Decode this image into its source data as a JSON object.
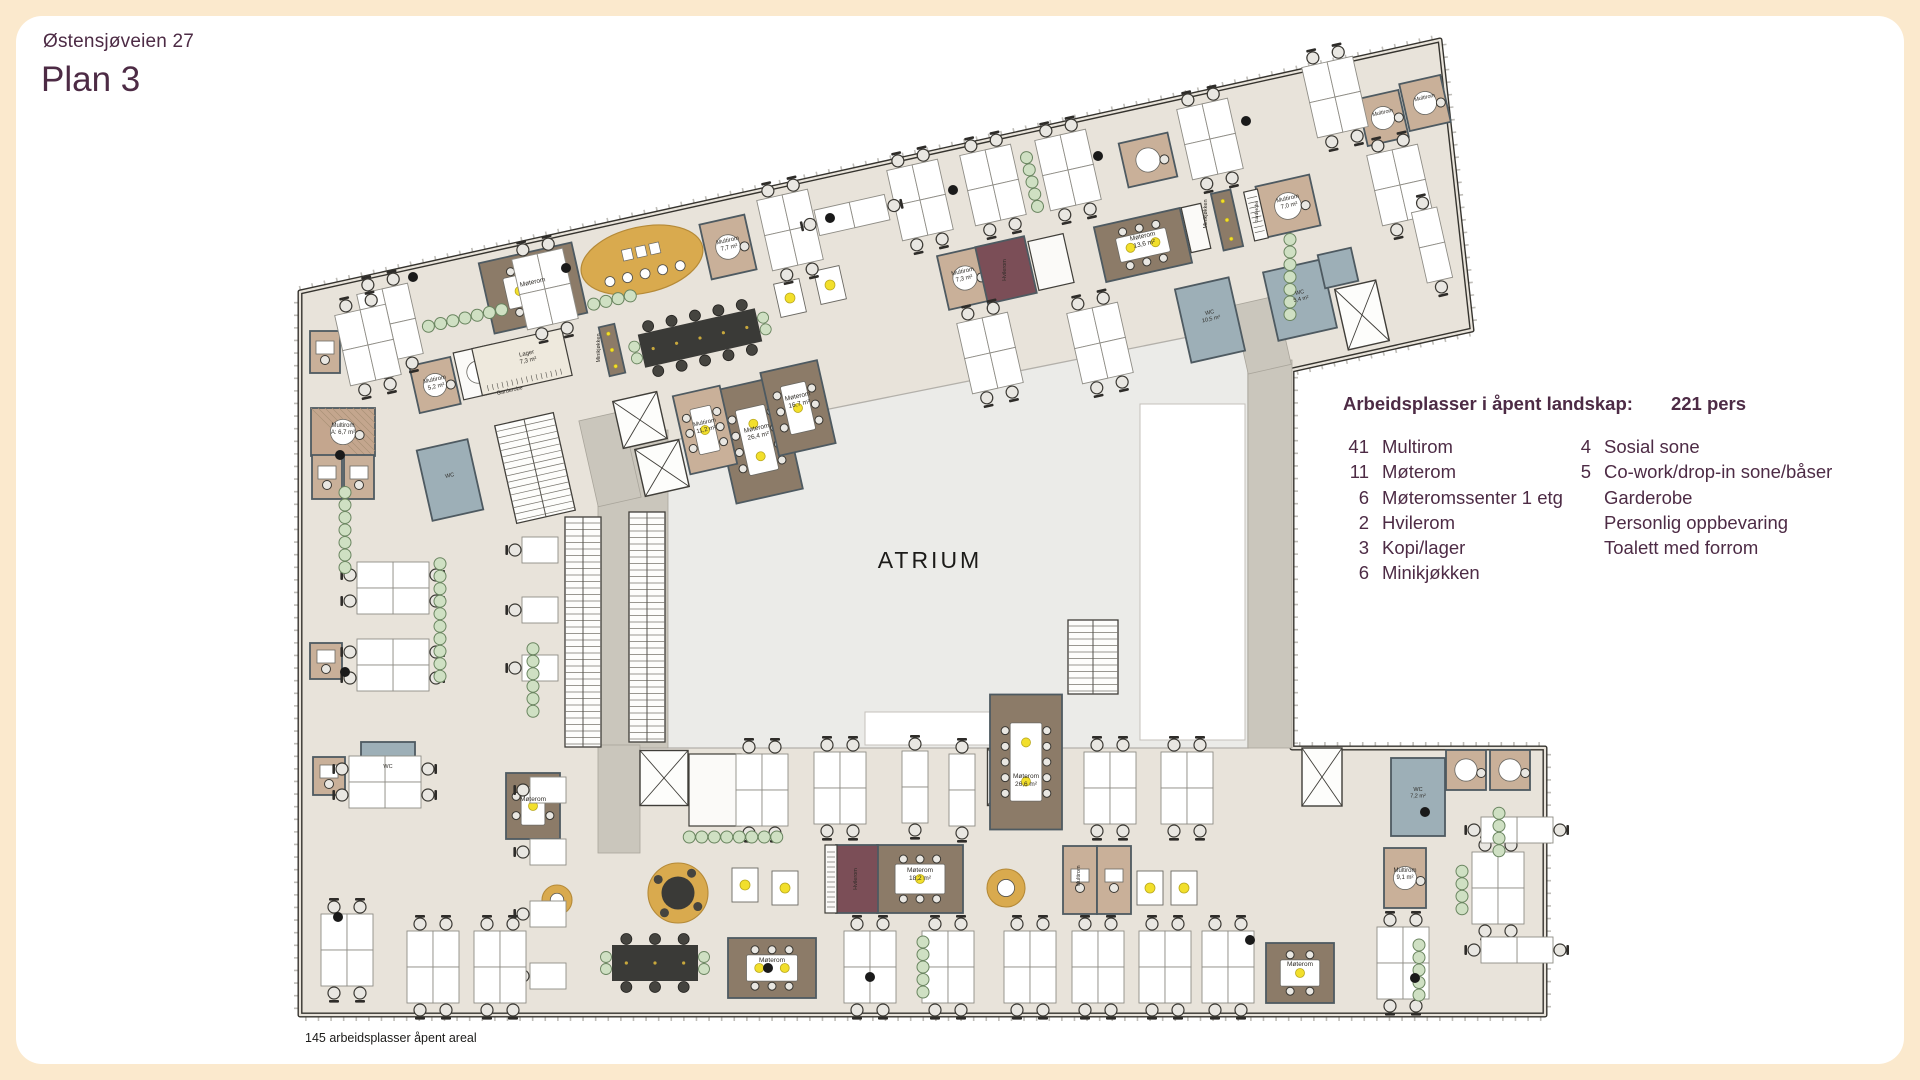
{
  "page": {
    "address": "Østensjøveien 27",
    "title": "Plan 3",
    "footnote": "145 arbeidsplasser åpent areal"
  },
  "legend": {
    "header": "Arbeidsplasser i åpent landskap:",
    "persons": "221 pers",
    "col1": [
      {
        "n": "41",
        "label": "Multirom"
      },
      {
        "n": "11",
        "label": "Møterom"
      },
      {
        "n": "6",
        "label": "Møteromssenter 1 etg"
      },
      {
        "n": "2",
        "label": "Hvilerom"
      },
      {
        "n": "3",
        "label": "Kopi/lager"
      },
      {
        "n": "6",
        "label": "Minikjøkken"
      }
    ],
    "col2": [
      {
        "n": "4",
        "label": "Sosial sone"
      },
      {
        "n": "5",
        "label": "Co-work/drop-in sone/båser"
      },
      {
        "n": "",
        "label": "Garderobe"
      },
      {
        "n": "",
        "label": "Personlig oppbevaring"
      },
      {
        "n": "",
        "label": "Toalett med forrom"
      }
    ]
  },
  "plan": {
    "atrium_label": "ATRIUM",
    "colors": {
      "floor": "#e8e3da",
      "wall": "#35332e",
      "tick": "#8a867e",
      "atrium": "#ebebe8",
      "atrium_edge": "#b3b0aa",
      "corridor": "#cac6bc",
      "brown": "#8c7b68",
      "tan": "#c9b099",
      "tanh": "#c4a68e",
      "blue": "#9dafb7",
      "maroon": "#7b4e57",
      "white": "#fbfaf8",
      "cream": "#eee9dd",
      "room_edge": "#4e5a61",
      "white_edge": "#403e39",
      "gold": "#d9aa4e",
      "gold_edge": "#b58a38",
      "green": "#cfe0c3",
      "green_edge": "#6a8560",
      "desk": "#ffffff",
      "desk_edge": "#8f8d86",
      "chair": "#e9e7e2",
      "chair_edge": "#3a3833",
      "dark_table": "#3a3a37",
      "dark_chair": "#45443f",
      "yellow": "#f2df2b",
      "yellow_edge": "#b9a81c",
      "label": "#2f2c27",
      "atrium_text": "#1c1b19"
    },
    "outline": [
      [
        300,
        292
      ],
      [
        1440,
        40
      ],
      [
        1472,
        330
      ],
      [
        1292,
        370
      ],
      [
        1292,
        748
      ],
      [
        1545,
        748
      ],
      [
        1545,
        1015
      ],
      [
        300,
        1015
      ]
    ],
    "atrium": {
      "poly": [
        [
          600,
          455
        ],
        [
          1248,
          325
        ],
        [
          1248,
          748
        ],
        [
          600,
          748
        ]
      ],
      "whites": [
        [
          1140,
          404,
          105,
          336
        ],
        [
          865,
          712,
          128,
          33
        ]
      ]
    },
    "corridors": [
      [
        598,
        430,
        70,
        318,
        0
      ],
      [
        1248,
        360,
        44,
        388,
        0
      ],
      [
        598,
        745,
        42,
        108,
        0
      ],
      [
        588,
        415,
        44,
        88,
        -12.7
      ],
      [
        1240,
        300,
        44,
        70,
        -12.7
      ]
    ],
    "stairs": [
      [
        583,
        632,
        36,
        230,
        0
      ],
      [
        647,
        627,
        36,
        230,
        0
      ],
      [
        535,
        468,
        60,
        100,
        -12.7
      ],
      [
        1093,
        657,
        50,
        74,
        0
      ]
    ],
    "lifts": [
      [
        640,
        420,
        45,
        48,
        -12.7
      ],
      [
        662,
        468,
        45,
        48,
        -12.7
      ],
      [
        1362,
        315,
        42,
        62,
        -12.7
      ],
      [
        664,
        778,
        48,
        55,
        0
      ],
      [
        1010,
        777,
        45,
        57,
        0
      ],
      [
        1322,
        777,
        40,
        58,
        0
      ]
    ],
    "rooms": [
      [
        533,
        288,
        95,
        72,
        -12.7,
        "brown",
        "mt"
      ],
      [
        1143,
        245,
        88,
        56,
        -12.7,
        "brown",
        "mt"
      ],
      [
        757,
        440,
        68,
        115,
        -12.7,
        "brown",
        "mt"
      ],
      [
        798,
        408,
        58,
        85,
        -12.7,
        "brown",
        "mt"
      ],
      [
        533,
        806,
        54,
        66,
        0,
        "brown",
        "mt"
      ],
      [
        920,
        879,
        86,
        68,
        0,
        "brown",
        "mt"
      ],
      [
        1026,
        762,
        72,
        135,
        0,
        "brown",
        "mt"
      ],
      [
        772,
        968,
        88,
        60,
        0,
        "brown",
        "mt"
      ],
      [
        1300,
        973,
        68,
        60,
        0,
        "brown",
        "mt"
      ],
      [
        612,
        350,
        16,
        50,
        -12.7,
        "brown",
        "bar"
      ],
      [
        1227,
        220,
        20,
        58,
        -12.7,
        "brown",
        "bar"
      ],
      [
        728,
        247,
        46,
        56,
        -12.7,
        "tan",
        "rt"
      ],
      [
        1288,
        206,
        55,
        52,
        -12.7,
        "tan",
        "rt"
      ],
      [
        965,
        278,
        45,
        55,
        -12.7,
        "tan",
        "rt"
      ],
      [
        705,
        430,
        48,
        80,
        -12.7,
        "tan",
        "mt"
      ],
      [
        435,
        385,
        42,
        48,
        -12.7,
        "tan",
        "rt"
      ],
      [
        478,
        372,
        40,
        48,
        -12.7,
        "white",
        "rt"
      ],
      [
        1383,
        118,
        42,
        48,
        -12.7,
        "tan",
        "rt"
      ],
      [
        1425,
        103,
        42,
        48,
        -12.7,
        "tan",
        "rt"
      ],
      [
        1148,
        160,
        50,
        45,
        -12.7,
        "tan",
        "rt"
      ],
      [
        343,
        432,
        64,
        48,
        0,
        "tanh",
        "rt"
      ],
      [
        327,
        477,
        30,
        44,
        0,
        "tan",
        "s1"
      ],
      [
        359,
        477,
        30,
        44,
        0,
        "tan",
        "s1"
      ],
      [
        325,
        352,
        30,
        42,
        0,
        "tan",
        "s1"
      ],
      [
        326,
        661,
        32,
        36,
        0,
        "tan",
        "s1"
      ],
      [
        329,
        776,
        32,
        38,
        0,
        "tan",
        "s1"
      ],
      [
        1080,
        880,
        34,
        68,
        0,
        "tan",
        "s1"
      ],
      [
        1114,
        880,
        34,
        68,
        0,
        "tan",
        "s1"
      ],
      [
        1466,
        770,
        40,
        40,
        0,
        "tan",
        "rt"
      ],
      [
        1510,
        770,
        40,
        40,
        0,
        "tan",
        "rt"
      ],
      [
        1405,
        878,
        42,
        60,
        0,
        "tan",
        "rt"
      ],
      [
        1006,
        270,
        50,
        58,
        -12.7,
        "maroon",
        "none"
      ],
      [
        857,
        879,
        42,
        68,
        0,
        "maroon",
        "none"
      ],
      [
        1210,
        320,
        55,
        75,
        -12.7,
        "blue",
        "none"
      ],
      [
        1300,
        300,
        60,
        70,
        -12.7,
        "blue",
        "none"
      ],
      [
        1338,
        268,
        34,
        34,
        -12.7,
        "blue",
        "none"
      ],
      [
        450,
        480,
        52,
        72,
        -12.7,
        "blue",
        "none"
      ],
      [
        388,
        772,
        54,
        60,
        0,
        "blue",
        "none"
      ],
      [
        1418,
        797,
        54,
        78,
        0,
        "blue",
        "none"
      ],
      [
        522,
        362,
        92,
        48,
        -12.7,
        "cream",
        "wr"
      ],
      [
        1256,
        215,
        14,
        50,
        -12.7,
        "white",
        "wr"
      ],
      [
        1051,
        262,
        36,
        50,
        -12.7,
        "white",
        "none"
      ],
      [
        1196,
        228,
        20,
        46,
        -12.7,
        "white",
        "none"
      ],
      [
        715,
        790,
        52,
        72,
        0,
        "white",
        "none"
      ],
      [
        831,
        879,
        12,
        68,
        0,
        "white",
        "wr"
      ]
    ],
    "dark_tables": [
      [
        700,
        338,
        120,
        34,
        -12.7
      ],
      [
        655,
        963,
        86,
        36,
        0
      ]
    ],
    "gold_oval": [
      642,
      260,
      62,
      33,
      -12.7
    ],
    "gold_rounds": [
      [
        678,
        893,
        30
      ],
      [
        557,
        900,
        15
      ],
      [
        1006,
        888,
        19
      ]
    ],
    "yellow_tables": [
      [
        790,
        298,
        -12.7
      ],
      [
        830,
        285,
        -12.7
      ],
      [
        745,
        885,
        0
      ],
      [
        785,
        888,
        0
      ],
      [
        1150,
        888,
        0
      ],
      [
        1184,
        888,
        0
      ]
    ],
    "desks": [
      [
        "q",
        390,
        324,
        -12.7
      ],
      [
        "q",
        545,
        289,
        -12.7
      ],
      [
        "q",
        790,
        230,
        -12.7
      ],
      [
        "q",
        920,
        200,
        -12.7
      ],
      [
        "q",
        993,
        185,
        -12.7
      ],
      [
        "q",
        1068,
        170,
        -12.7
      ],
      [
        "q",
        1210,
        139,
        -12.7
      ],
      [
        "q",
        1335,
        97,
        -12.7
      ],
      [
        "q",
        1400,
        185,
        -12.7
      ],
      [
        "d",
        1432,
        245,
        -12.7
      ],
      [
        "q",
        990,
        353,
        -12.7
      ],
      [
        "q",
        1100,
        343,
        -12.7
      ],
      [
        "d",
        852,
        215,
        77.3
      ],
      [
        "q",
        368,
        345,
        -12.7
      ],
      [
        "q",
        393,
        588,
        90
      ],
      [
        "q",
        393,
        665,
        90
      ],
      [
        "q",
        385,
        782,
        90
      ],
      [
        "s",
        540,
        550,
        90
      ],
      [
        "s",
        540,
        610,
        90
      ],
      [
        "s",
        540,
        668,
        90
      ],
      [
        "s",
        548,
        790,
        90
      ],
      [
        "s",
        548,
        852,
        90
      ],
      [
        "s",
        548,
        914,
        90
      ],
      [
        "s",
        548,
        976,
        90
      ],
      [
        "q",
        347,
        950,
        0
      ],
      [
        "q",
        433,
        967,
        0
      ],
      [
        "q",
        500,
        967,
        0
      ],
      [
        "q",
        762,
        790,
        0
      ],
      [
        "q",
        840,
        788,
        0
      ],
      [
        "d",
        915,
        787,
        0
      ],
      [
        "d",
        962,
        790,
        0
      ],
      [
        "q",
        1110,
        788,
        0
      ],
      [
        "q",
        1187,
        788,
        0
      ],
      [
        "q",
        870,
        967,
        0
      ],
      [
        "q",
        948,
        967,
        0
      ],
      [
        "q",
        1030,
        967,
        0
      ],
      [
        "q",
        1098,
        967,
        0
      ],
      [
        "q",
        1165,
        967,
        0
      ],
      [
        "q",
        1228,
        967,
        0
      ],
      [
        "q",
        1403,
        963,
        0
      ],
      [
        "q",
        1498,
        888,
        0
      ],
      [
        "d",
        1517,
        830,
        90
      ],
      [
        "d",
        1517,
        950,
        90
      ]
    ],
    "plants": [
      [
        465,
        318,
        7,
        -12.7
      ],
      [
        1032,
        182,
        5,
        77.3
      ],
      [
        1290,
        277,
        7,
        90
      ],
      [
        345,
        530,
        7,
        90
      ],
      [
        440,
        620,
        10,
        90
      ],
      [
        533,
        680,
        6,
        90
      ],
      [
        733,
        837,
        8,
        0
      ],
      [
        923,
        967,
        5,
        90
      ],
      [
        1419,
        970,
        5,
        90
      ],
      [
        1462,
        890,
        4,
        90
      ],
      [
        1499,
        832,
        4,
        90
      ],
      [
        612,
        300,
        4,
        -12.7
      ]
    ],
    "columns": [
      [
        413,
        277
      ],
      [
        566,
        268
      ],
      [
        830,
        218
      ],
      [
        953,
        190
      ],
      [
        1098,
        156
      ],
      [
        1246,
        121
      ],
      [
        340,
        455
      ],
      [
        345,
        672
      ],
      [
        768,
        968
      ],
      [
        870,
        977
      ],
      [
        1250,
        940
      ],
      [
        1425,
        812
      ],
      [
        1415,
        978
      ],
      [
        338,
        917
      ]
    ],
    "labels": [
      {
        "t": [
          "ATRIUM"
        ],
        "x": 930,
        "y": 568,
        "s": 23,
        "r": 0,
        "c": "#1c1b19",
        "sp": 3
      },
      {
        "t": [
          "Lager",
          "7,3 m²"
        ],
        "x": 527,
        "y": 355,
        "s": 6,
        "r": -12.7
      },
      {
        "t": [
          "Garderobe"
        ],
        "x": 510,
        "y": 392,
        "s": 5.5,
        "r": -12.7
      },
      {
        "t": [
          "Minikjøkken"
        ],
        "x": 600,
        "y": 348,
        "s": 5.5,
        "r": -90
      },
      {
        "t": [
          "Minikjøkken"
        ],
        "x": 1207,
        "y": 214,
        "s": 5.5,
        "r": -90
      },
      {
        "t": [
          "Garderobe"
        ],
        "x": 1258,
        "y": 212,
        "s": 4.5,
        "r": -90
      },
      {
        "t": [
          "Møterom"
        ],
        "x": 533,
        "y": 284,
        "s": 6.5,
        "r": -12.7
      },
      {
        "t": [
          "Møterom",
          "13,6 m²"
        ],
        "x": 1143,
        "y": 238,
        "s": 6.5,
        "r": -12.7
      },
      {
        "t": [
          "Møterom",
          "26,4 m²"
        ],
        "x": 757,
        "y": 430,
        "s": 6.5,
        "r": -12.7
      },
      {
        "t": [
          "Møterom",
          "16,7 m²"
        ],
        "x": 798,
        "y": 398,
        "s": 6.5,
        "r": -12.7
      },
      {
        "t": [
          "Multirom",
          "7,7 m²"
        ],
        "x": 728,
        "y": 242,
        "s": 6,
        "r": -12.7
      },
      {
        "t": [
          "Multirom",
          "7,3 m²"
        ],
        "x": 963,
        "y": 273,
        "s": 6,
        "r": -12.7
      },
      {
        "t": [
          "Multirom",
          "7,0 m²"
        ],
        "x": 1288,
        "y": 200,
        "s": 6,
        "r": -12.7
      },
      {
        "t": [
          "Multirom",
          "11,2 m²"
        ],
        "x": 705,
        "y": 424,
        "s": 6,
        "r": -12.7
      },
      {
        "t": [
          "Multirom",
          "5,2 m²"
        ],
        "x": 435,
        "y": 381,
        "s": 6,
        "r": -12.7
      },
      {
        "t": [
          "Multirom",
          "A: 6,7 m²"
        ],
        "x": 343,
        "y": 427,
        "s": 6,
        "r": 0
      },
      {
        "t": [
          "Hvilerom"
        ],
        "x": 1006,
        "y": 270,
        "s": 5.5,
        "r": -90
      },
      {
        "t": [
          "Hvilerom"
        ],
        "x": 857,
        "y": 879,
        "s": 5.5,
        "r": -90
      },
      {
        "t": [
          "WC",
          "10,5 m²"
        ],
        "x": 1210,
        "y": 314,
        "s": 5.5,
        "r": -12.7
      },
      {
        "t": [
          "WC",
          "5,4 m²"
        ],
        "x": 1300,
        "y": 294,
        "s": 5.5,
        "r": -12.7
      },
      {
        "t": [
          "WC"
        ],
        "x": 450,
        "y": 477,
        "s": 5.5,
        "r": -12.7
      },
      {
        "t": [
          "WC"
        ],
        "x": 388,
        "y": 768,
        "s": 5.5,
        "r": 0
      },
      {
        "t": [
          "WC",
          "7,2 m²"
        ],
        "x": 1418,
        "y": 791,
        "s": 5.5,
        "r": 0
      },
      {
        "t": [
          "Møterom"
        ],
        "x": 533,
        "y": 801,
        "s": 6.5,
        "r": 0
      },
      {
        "t": [
          "Møterom",
          "18,2 m²"
        ],
        "x": 920,
        "y": 872,
        "s": 6.5,
        "r": 0
      },
      {
        "t": [
          "Møterom",
          "26,6 m²"
        ],
        "x": 1026,
        "y": 778,
        "s": 6.5,
        "r": 0
      },
      {
        "t": [
          "Møterom"
        ],
        "x": 772,
        "y": 962,
        "s": 6.5,
        "r": 0
      },
      {
        "t": [
          "Møterom"
        ],
        "x": 1300,
        "y": 966,
        "s": 6.5,
        "r": 0
      },
      {
        "t": [
          "Multirom"
        ],
        "x": 1383,
        "y": 114,
        "s": 5.5,
        "r": -12.7
      },
      {
        "t": [
          "Multirom"
        ],
        "x": 1425,
        "y": 99,
        "s": 5.5,
        "r": -12.7
      },
      {
        "t": [
          "Multirom",
          "9,1 m²"
        ],
        "x": 1405,
        "y": 872,
        "s": 6,
        "r": 0
      },
      {
        "t": [
          "Multirom"
        ],
        "x": 1080,
        "y": 876,
        "s": 5.5,
        "r": -90
      }
    ]
  }
}
